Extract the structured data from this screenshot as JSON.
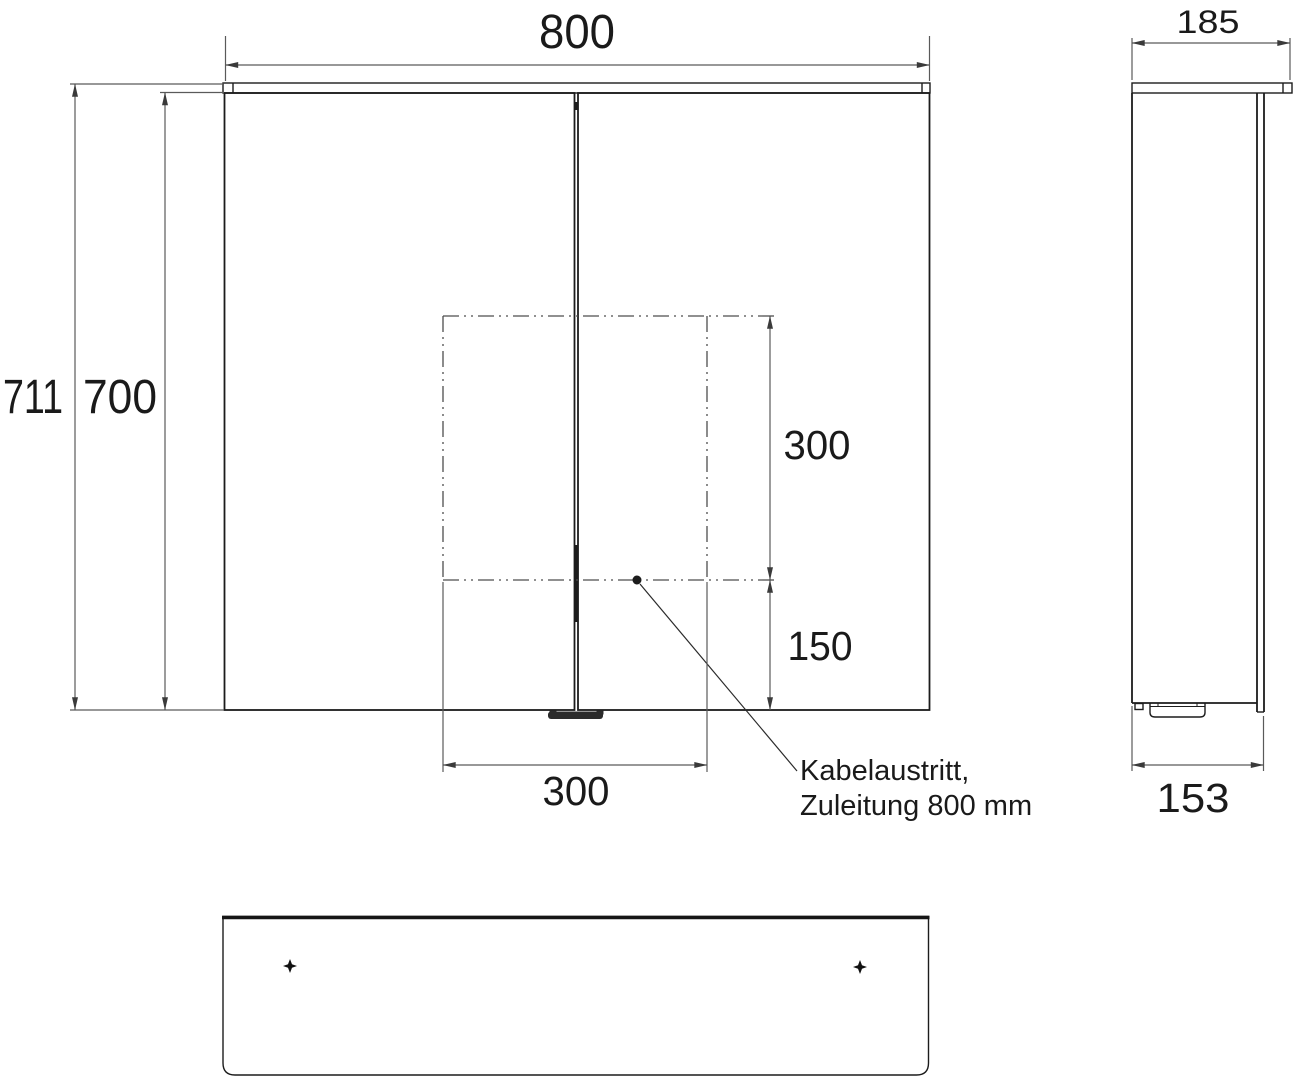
{
  "drawing": {
    "kind": "technical-drawing",
    "views": [
      "front",
      "side",
      "bottom"
    ]
  },
  "dims": {
    "width": "800",
    "depth": "185",
    "height_total": "711",
    "height_body": "700",
    "cutout_height": "300",
    "cutout_offset_bottom": "150",
    "cutout_width": "300",
    "depth_body": "153"
  },
  "note": {
    "line1": "Kabelaustritt,",
    "line2": "Zuleitung 800 mm"
  },
  "colors": {
    "background": "#ffffff",
    "line_main": "#1c1c1c",
    "line_dimension": "#5a5a5a",
    "line_dashed": "#4d4d4d",
    "text": "#1a1a1a"
  }
}
